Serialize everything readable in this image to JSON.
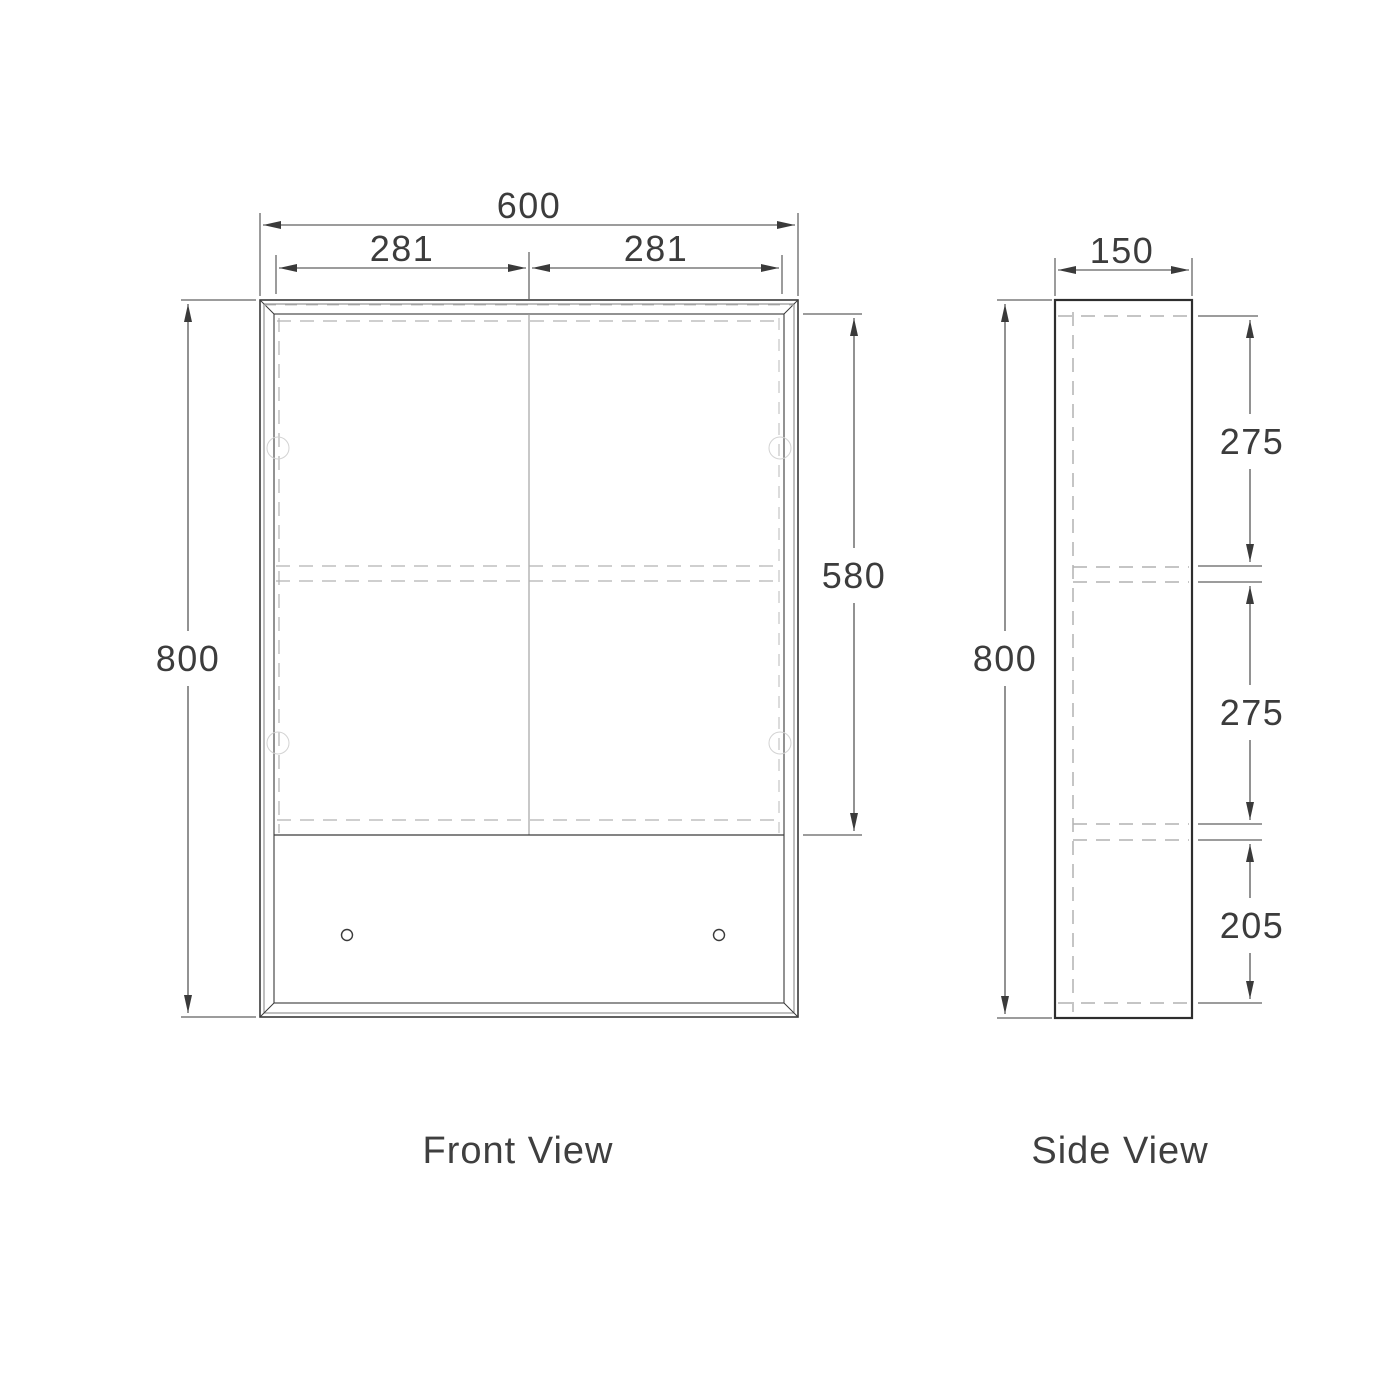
{
  "front_view": {
    "label": "Front View",
    "dims": {
      "overall_width": "600",
      "left_door_width": "281",
      "right_door_width": "281",
      "overall_height": "800",
      "door_height": "580"
    }
  },
  "side_view": {
    "label": "Side View",
    "dims": {
      "depth": "150",
      "overall_height": "800",
      "top_section": "275",
      "middle_section": "275",
      "bottom_section": "205"
    }
  },
  "colors": {
    "line": "#3a3a3a",
    "hidden_line": "#b2b2b2",
    "background": "#ffffff"
  }
}
